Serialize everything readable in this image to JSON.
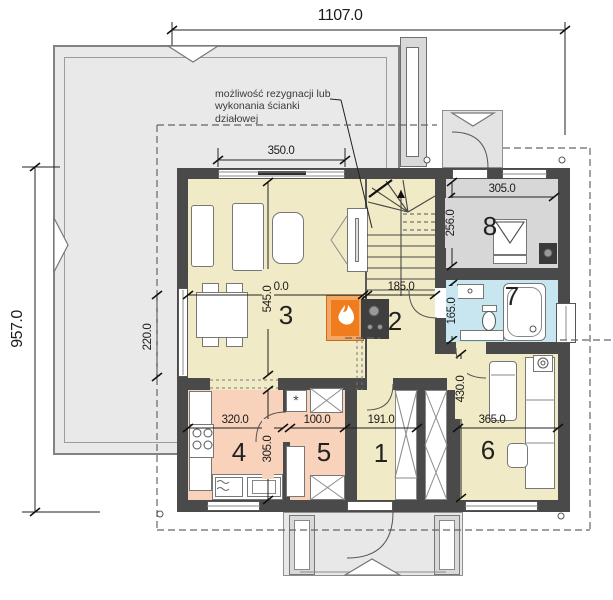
{
  "annotation": {
    "partition_note": "możliwość rezygnacji lub wykonania ścianki działowej"
  },
  "symbols": {
    "pantry_appliance": "*"
  },
  "rooms": [
    {
      "number": "1"
    },
    {
      "number": "2"
    },
    {
      "number": "3"
    },
    {
      "number": "4"
    },
    {
      "number": "5"
    },
    {
      "number": "6"
    },
    {
      "number": "7"
    },
    {
      "number": "8"
    }
  ],
  "dimensions": {
    "overall_width": "1107.0",
    "overall_depth": "957.0",
    "living_window": "350.0",
    "utility_width": "305.0",
    "utility_depth": "256.0",
    "living_width": "510.0",
    "hall_top_width": "185.0",
    "living_depth": "545.0",
    "bath_depth": "165.0",
    "terrace_door": "220.0",
    "kitchen_width": "320.0",
    "pantry_width": "100.0",
    "hall_width": "191.0",
    "kitchen_depth": "305.0",
    "room6_width": "365.0",
    "room6_depth": "430.0"
  },
  "colors": {
    "floor_main": "#f0ebc6",
    "floor_kitchen": "#f8d2bb",
    "floor_bath": "#c8e6f0",
    "floor_utility": "#d7d7d7",
    "wall": "#4a4a4a",
    "terrace": "#e9e9e9",
    "fireplace_accent": "#f07d1e"
  }
}
